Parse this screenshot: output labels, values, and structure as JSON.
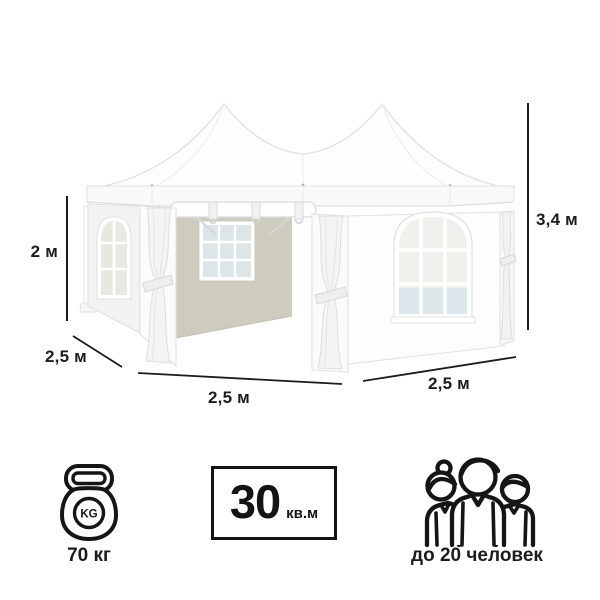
{
  "diagram": {
    "subject": "white pagoda tent with two peaks, arched windows and tied curtains",
    "dimensions": {
      "wall_height": "2 м",
      "total_height": "3,4 м",
      "depth_left": "2,5 м",
      "width_front": "2,5 м",
      "width_right": "2,5 м"
    }
  },
  "features": {
    "weight": {
      "icon": "kettlebell-icon",
      "badge_text": "KG",
      "label": "70 кг"
    },
    "area": {
      "icon": "area-box",
      "value": "30",
      "unit": "кв.м"
    },
    "capacity": {
      "icon": "people-group-icon",
      "label": "до 20 человек"
    }
  },
  "colors": {
    "text": "#1c1c1c",
    "dimension_line": "#1c1c1c",
    "background": "#ffffff",
    "tent_white": "#fdfdfe",
    "interior_wall": "#cdccbe"
  }
}
